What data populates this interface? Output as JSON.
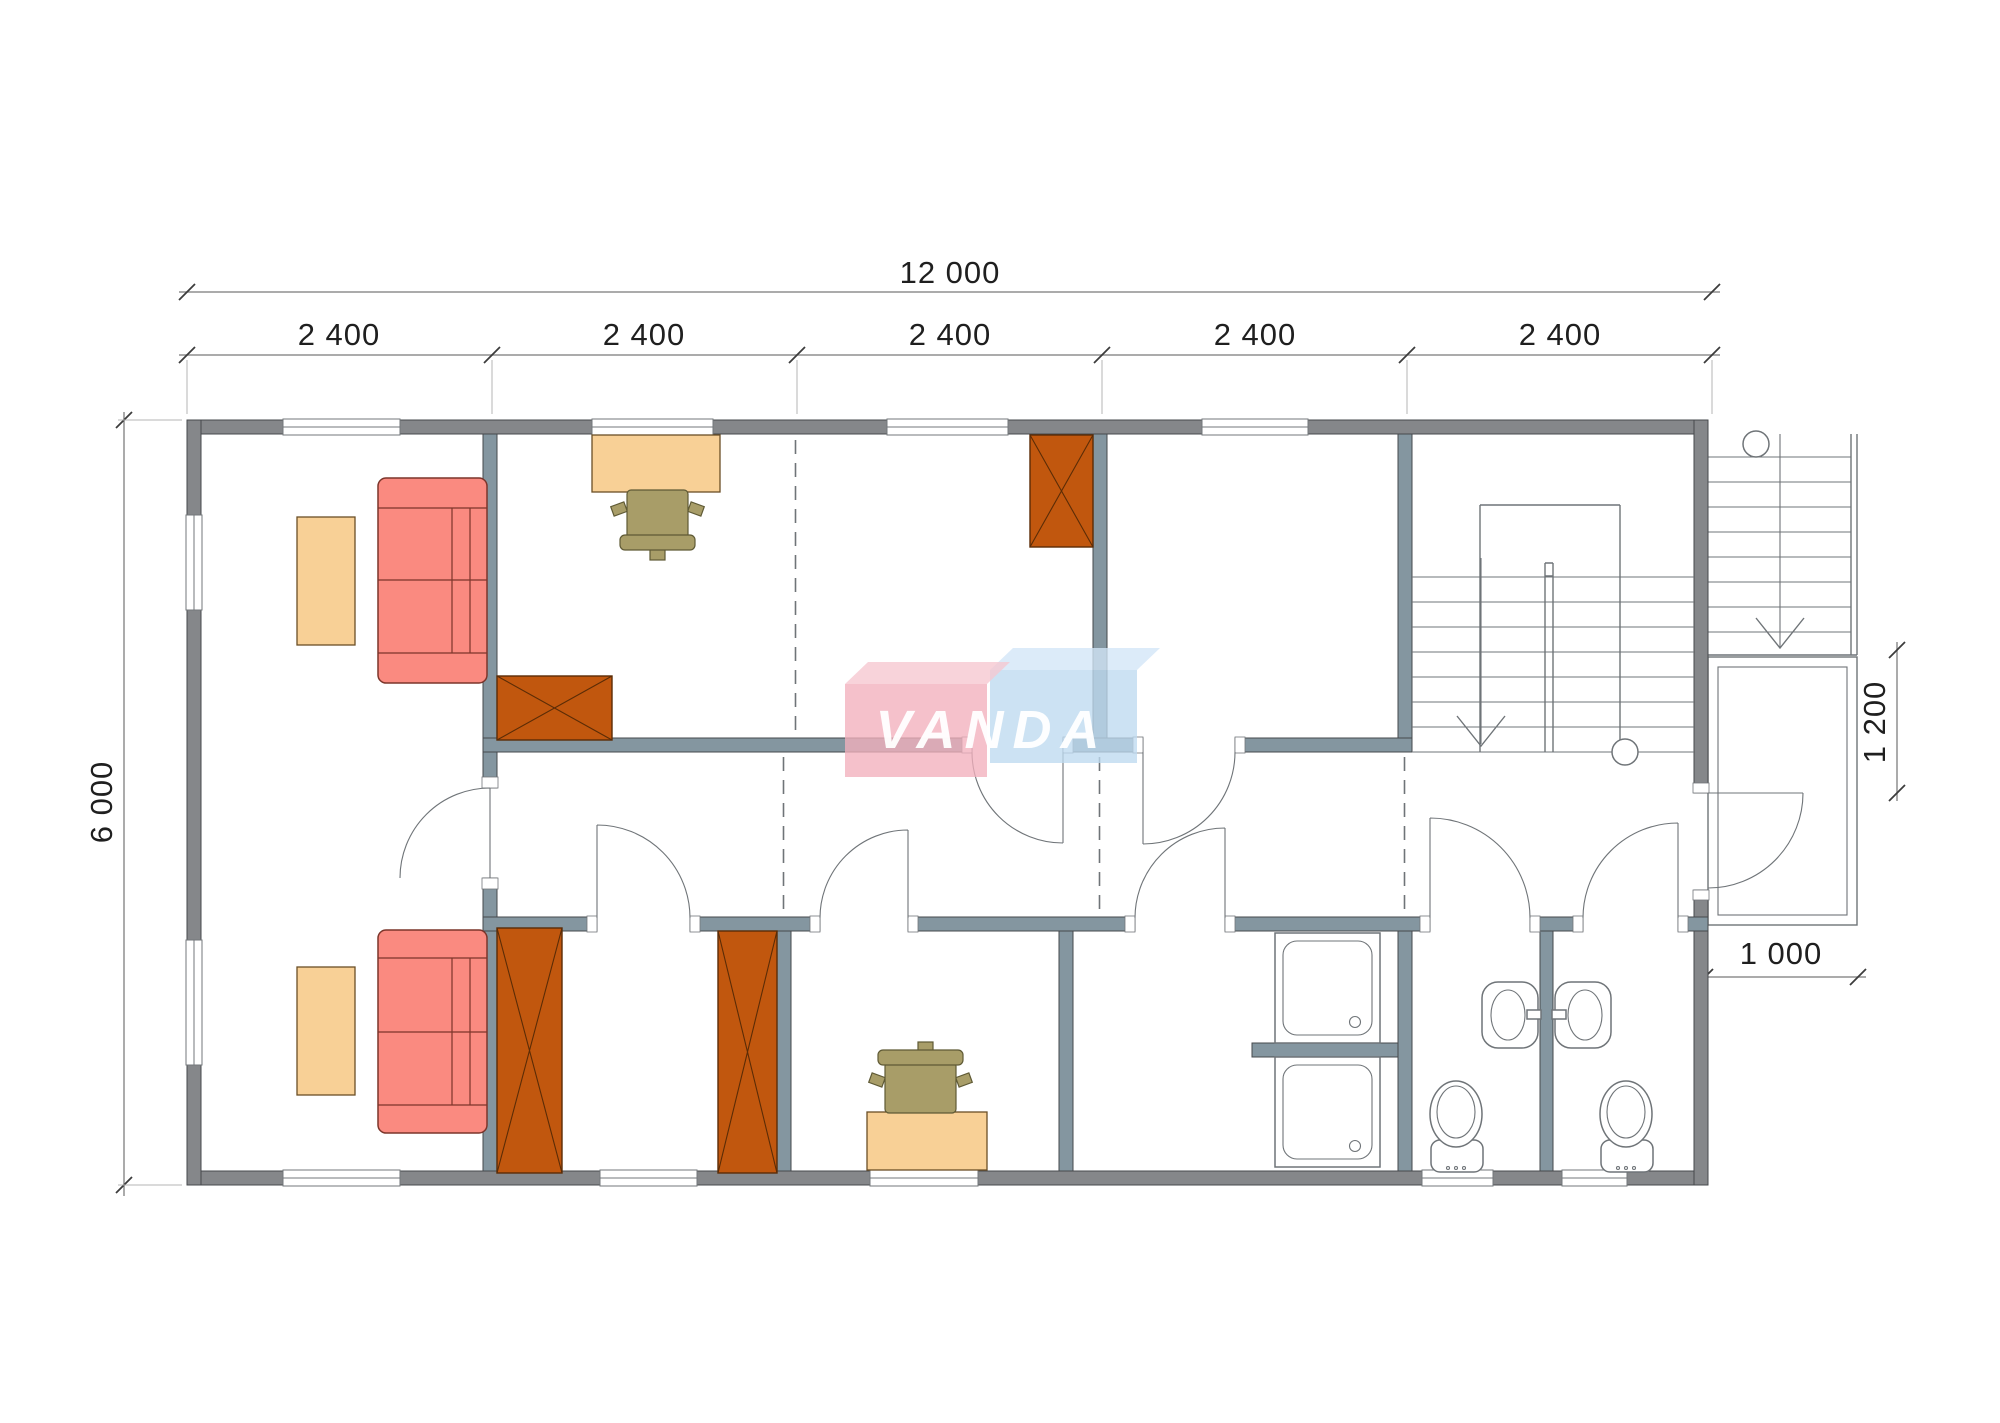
{
  "dimensions": {
    "total_width": "12 000",
    "modules": [
      "2 400",
      "2 400",
      "2 400",
      "2 400",
      "2 400"
    ],
    "height": "6 000",
    "porch_depth": "1 200",
    "porch_width": "1 000"
  },
  "watermark": {
    "text": "VANDA"
  },
  "colors": {
    "wall": "#85878a",
    "iwall": "#8496a0",
    "wall-stroke": "#46494c",
    "frame": "#73777b",
    "line": "#6f7478",
    "sofa": "#fa8a80",
    "sofa-stroke": "#7c352a",
    "table": "#f8d096",
    "table-stroke": "#6b4f26",
    "chair": "#a89d68",
    "chair-stroke": "#5f5a35",
    "wardrobe": "#c1570e",
    "wardrobe-stroke": "#5b2c06",
    "dim": "#3c3c3c",
    "dimline": "#8f8f8f",
    "dimtext": "#1f1f1f",
    "logo-pink-front": "rgba(242,176,189,0.78)",
    "logo-pink-top": "rgba(246,199,208,0.78)",
    "logo-blue-front": "rgba(190,218,240,0.78)",
    "logo-blue-top": "rgba(210,230,247,0.78)"
  }
}
